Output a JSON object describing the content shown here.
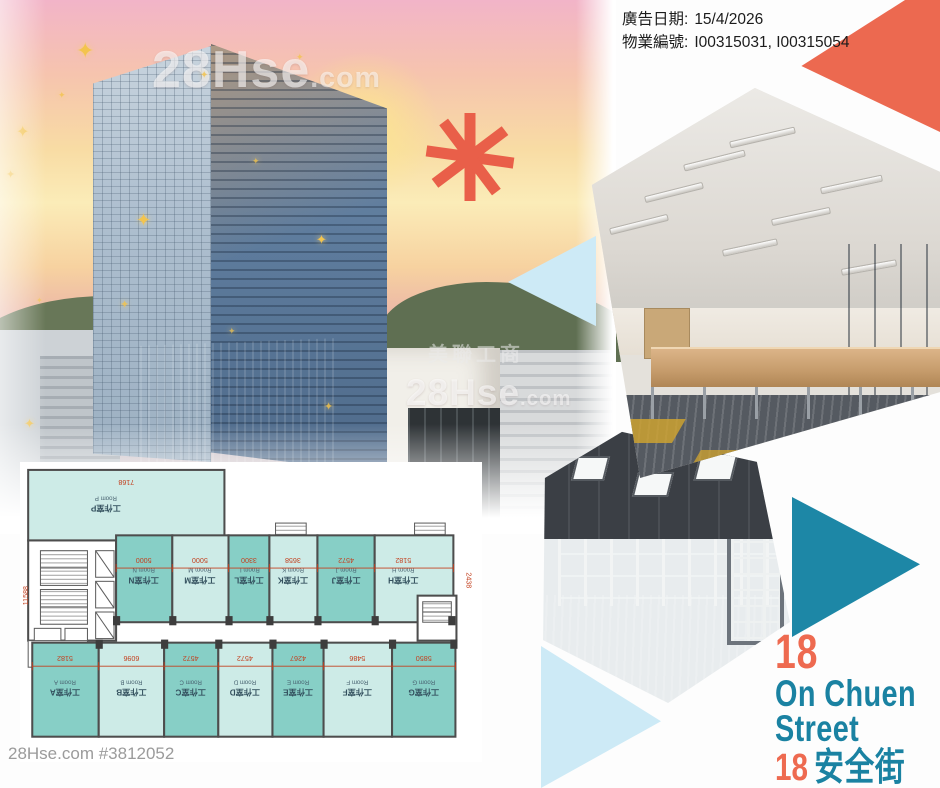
{
  "header": {
    "ad_date_label": "廣告日期:",
    "ad_date": "15/4/2026",
    "property_no_label": "物業編號:",
    "property_no": "I00315031, I00315054"
  },
  "watermark": {
    "brand": "28Hse",
    "tld": ".com",
    "agency": "美聯工商"
  },
  "building_photo": {
    "sign_text": "可祥物流"
  },
  "icons": {
    "sparkle": "✦"
  },
  "title": {
    "number": "18",
    "street_en_1": "On Chuen",
    "street_en_2": "Street",
    "number_zh_row": "18",
    "street_zh": "安全街"
  },
  "footer": {
    "listing_id": "28Hse.com #3812052"
  },
  "colors": {
    "accent_orange": "#EC6950",
    "accent_teal": "#1D87A6",
    "light_blue": "#CDEAF6",
    "unit_dark_teal": "#87CFC6",
    "unit_light_teal": "#CDEBE7",
    "dim_red": "#C3401F"
  },
  "floorplan": {
    "unit_p": {
      "cn": "工作室P",
      "en": "Room P"
    },
    "top_units": [
      {
        "cn": "工作室N",
        "en": "Room N"
      },
      {
        "cn": "工作室M",
        "en": "Room M"
      },
      {
        "cn": "工作室L",
        "en": "Room L"
      },
      {
        "cn": "工作室K",
        "en": "Room K"
      },
      {
        "cn": "工作室J",
        "en": "Room J"
      },
      {
        "cn": "工作室H",
        "en": "Room H"
      }
    ],
    "bottom_units": [
      {
        "cn": "工作室A",
        "en": "Room A"
      },
      {
        "cn": "工作室B",
        "en": "Room B"
      },
      {
        "cn": "工作室C",
        "en": "Room C"
      },
      {
        "cn": "工作室D",
        "en": "Room D"
      },
      {
        "cn": "工作室E",
        "en": "Room E"
      },
      {
        "cn": "工作室F",
        "en": "Room F"
      },
      {
        "cn": "工作室G",
        "en": "Room G"
      }
    ],
    "dims_top": [
      "5000",
      "5000",
      "3300",
      "3658",
      "4572",
      "5182"
    ],
    "dims_bottom": [
      "5182",
      "6096",
      "4572",
      "4572",
      "4267",
      "5486",
      "5850"
    ],
    "dims_misc": [
      "7168",
      "11588",
      "2438"
    ]
  }
}
